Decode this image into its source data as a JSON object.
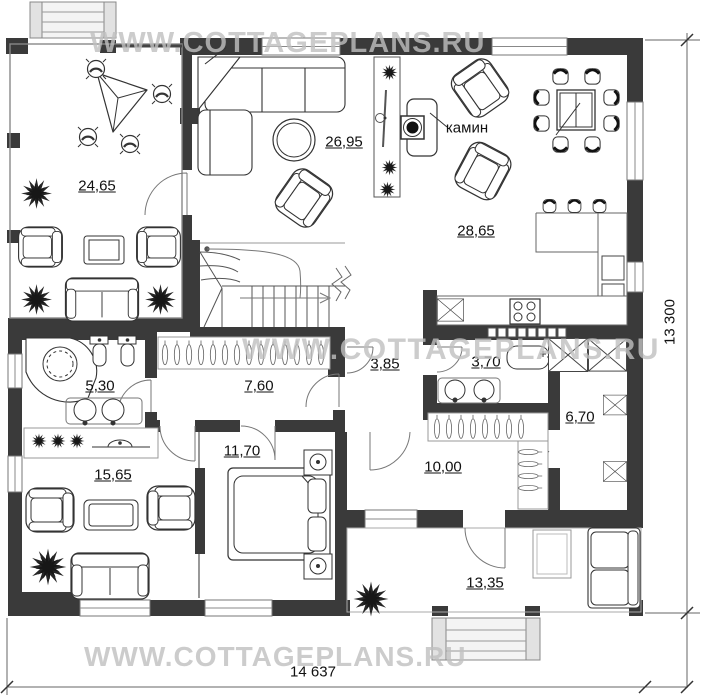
{
  "watermarks": {
    "top": "WWW.COTTAGEPLANS.RU",
    "middle": "WWW.COTTAGEPLANS.RU",
    "bottom": "WWW.COTTAGEPLANS.RU"
  },
  "dimensions": {
    "overall_width": "14 637",
    "overall_height": "13 300"
  },
  "annotations": {
    "fireplace": "камин"
  },
  "rooms": [
    {
      "name": "terrace",
      "area": "24,65"
    },
    {
      "name": "living-room",
      "area": "26,95"
    },
    {
      "name": "kitchen-dining",
      "area": "28,65"
    },
    {
      "name": "bathroom-1",
      "area": "5,30"
    },
    {
      "name": "corridor",
      "area": "7,60"
    },
    {
      "name": "hallway",
      "area": "3,85"
    },
    {
      "name": "bathroom-2",
      "area": "3,70"
    },
    {
      "name": "pantry",
      "area": "6,70"
    },
    {
      "name": "lounge",
      "area": "15,65"
    },
    {
      "name": "bedroom",
      "area": "11,70"
    },
    {
      "name": "hall",
      "area": "10,00"
    },
    {
      "name": "porch",
      "area": "13,35"
    }
  ],
  "colors": {
    "wall": "#3a3a3a",
    "line": "#333333",
    "dimension": "#555555",
    "watermark": "#c0c0c0"
  }
}
